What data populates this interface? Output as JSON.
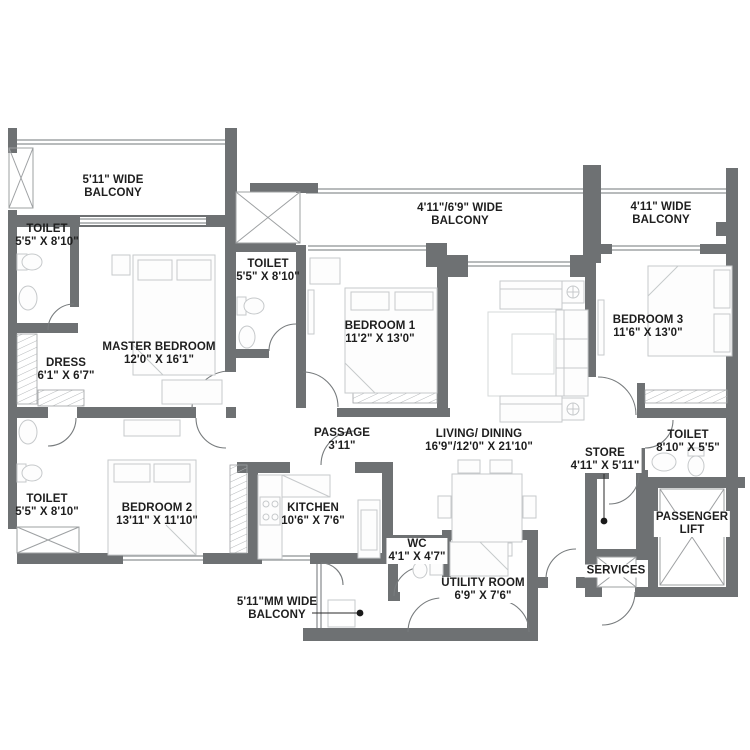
{
  "colors": {
    "wall": "#6e7173",
    "thin_line": "#8e9294",
    "furniture": "#c6c9cb",
    "hatch": "#b5b8ba",
    "door_arc": "#777b7d",
    "text": "#1e1e1e"
  },
  "labels": {
    "balcony_master": {
      "line1": "5'11\" WIDE",
      "line2": "BALCONY"
    },
    "toilet_master": {
      "line1": "TOILET",
      "line2": "5'5\" X 8'10\""
    },
    "master_bedroom": {
      "line1": "MASTER BEDROOM",
      "line2": "12'0\" X 16'1\""
    },
    "dress": {
      "line1": "DRESS",
      "line2": "6'1\" X 6'7\""
    },
    "toilet_left": {
      "line1": "TOILET",
      "line2": "5'5\" X 8'10\""
    },
    "bedroom2": {
      "line1": "BEDROOM 2",
      "line2": "13'11\" X 11'10\""
    },
    "toilet_mid": {
      "line1": "TOILET",
      "line2": "5'5\" X 8'10\""
    },
    "bedroom1": {
      "line1": "BEDROOM 1",
      "line2": "11'2\" X 13'0\""
    },
    "balcony_mid": {
      "line1": "4'11\"/6'9\" WIDE",
      "line2": "BALCONY"
    },
    "balcony_right": {
      "line1": "4'11\" WIDE",
      "line2": "BALCONY"
    },
    "bedroom3": {
      "line1": "BEDROOM 3",
      "line2": "11'6\" X 13'0\""
    },
    "passage": {
      "line1": "PASSAGE",
      "line2": "3'11\""
    },
    "living_dining": {
      "line1": "LIVING/ DINING",
      "line2": "16'9\"/12'0\" X 21'10\""
    },
    "kitchen": {
      "line1": "KITCHEN",
      "line2": "10'6\" X 7'6\""
    },
    "wc": {
      "line1": "WC",
      "line2": "4'1\" X 4'7\""
    },
    "utility_room": {
      "line1": "UTILITY ROOM",
      "line2": "6'9\" X 7'6\""
    },
    "store": {
      "line1": "STORE",
      "line2": "4'11\" X 5'11\""
    },
    "toilet_right": {
      "line1": "TOILET",
      "line2": "8'10\" X 5'5\""
    },
    "passenger_lift": {
      "line1": "PASSENGER",
      "line2": "LIFT"
    },
    "services": {
      "line1": "SERVICES"
    },
    "balcony_bottom": {
      "line1": "5'11\"MM WIDE",
      "line2": "BALCONY"
    }
  }
}
